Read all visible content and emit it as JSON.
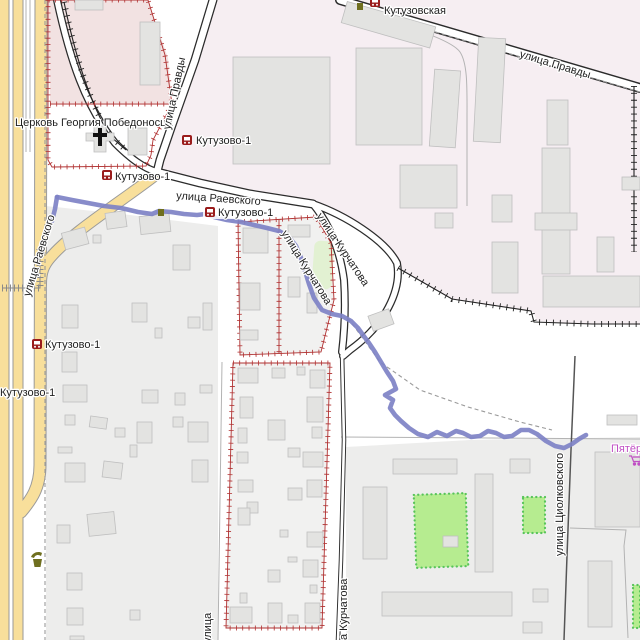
{
  "map": {
    "streets": {
      "pravdy": "улица Правды",
      "raevskogo": "улица Раевского",
      "kurchatova": "улица Курчатова",
      "tsiolkovskogo": "улица Циолковского",
      "ulitsa_partial": "улица",
      "kurchatova_partial": "а Курчатова"
    },
    "transit": {
      "kutuzovo1": "Кутузово-1",
      "kutuzovskaya": "Кутузовская"
    },
    "places": {
      "church": "Церковь Георгия Победоносца",
      "supermarket_partial": "Пятёр"
    },
    "colors": {
      "gps_track": "#7e82c6",
      "yellow_road": "#f8df9b",
      "fence_red": "#b03030",
      "industrial_area": "#f6eef2",
      "religious_area": "#f2e2e2",
      "residential_area": "#ededec",
      "playground_green": "#b6ec90",
      "transit_icon": "#9a1c1c",
      "supermarket_label": "#c04fc4",
      "amenity_icon_olive": "#6f6f1f"
    }
  }
}
